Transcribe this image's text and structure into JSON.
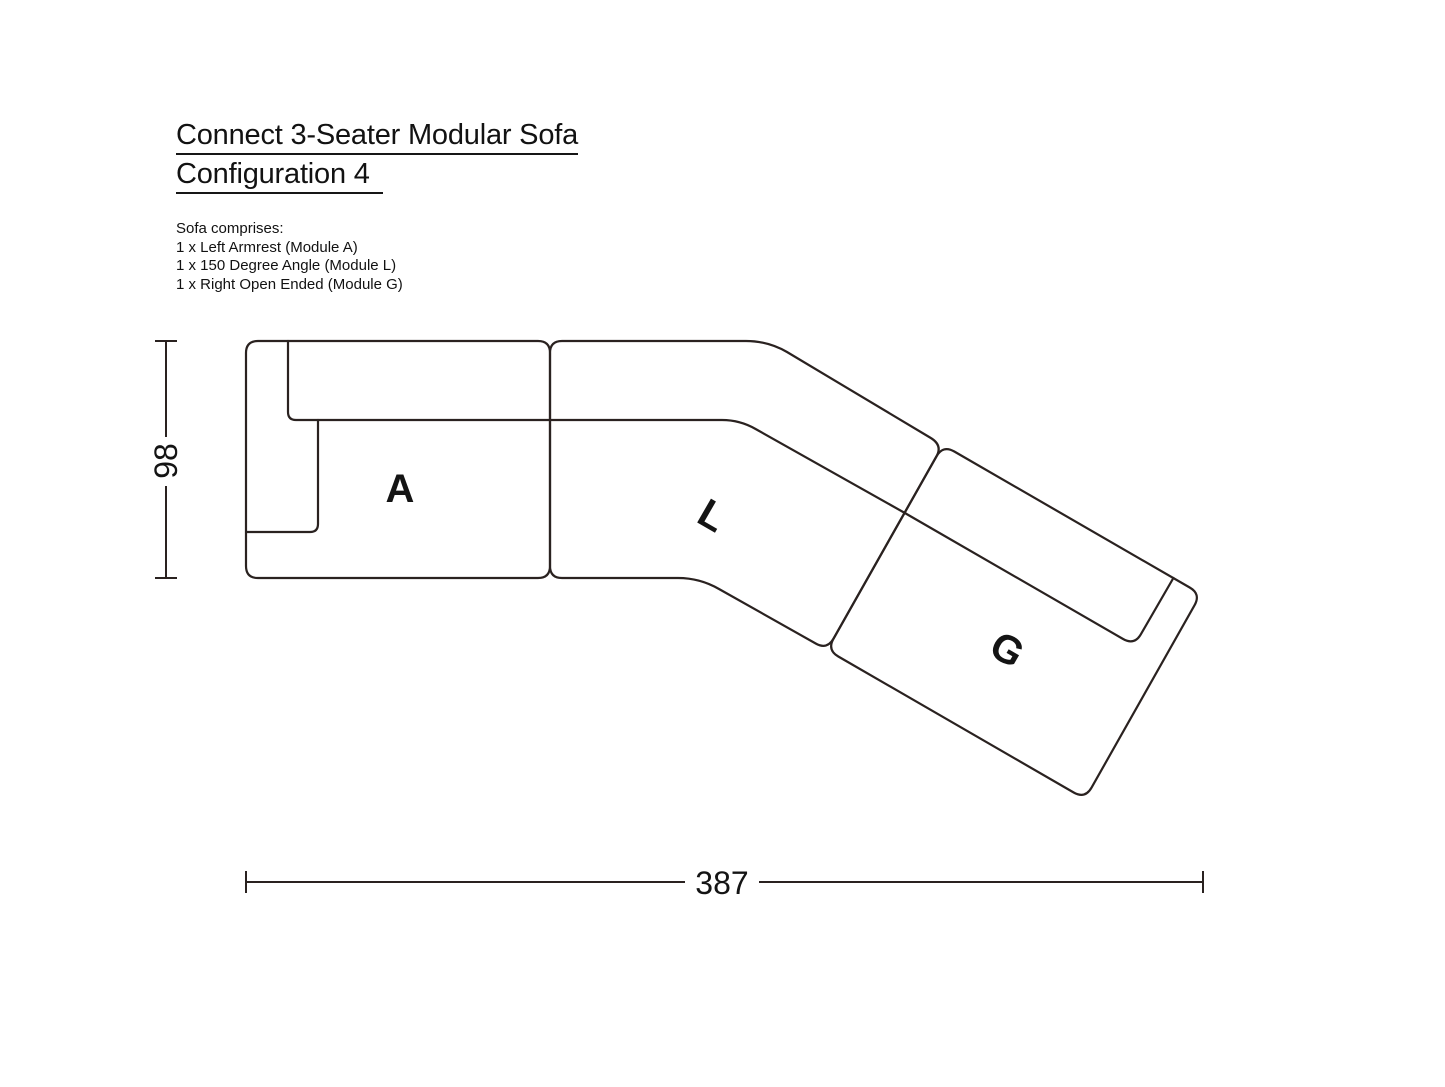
{
  "header": {
    "title_line1": "Connect 3-Seater Modular Sofa",
    "title_line2": "Configuration 4"
  },
  "comprises": {
    "heading": "Sofa comprises:",
    "items": [
      "1 x Left Armrest (Module A)",
      "1 x 150 Degree Angle (Module L)",
      "1 x Right Open Ended (Module G)"
    ]
  },
  "diagram": {
    "modules": [
      {
        "label": "A"
      },
      {
        "label": "L"
      },
      {
        "label": "G"
      }
    ],
    "dimensions": {
      "height": "98",
      "width": "387"
    },
    "line_color": "#2a2220",
    "text_color": "#141414"
  }
}
